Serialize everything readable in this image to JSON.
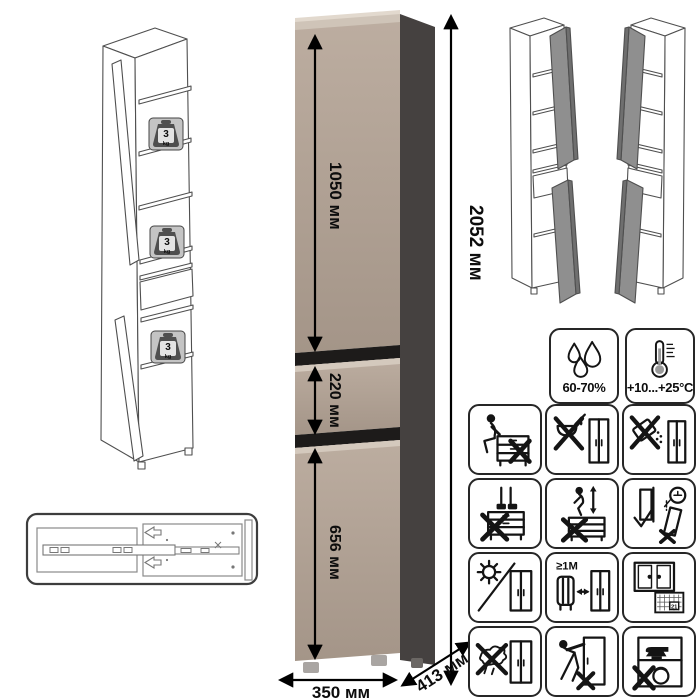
{
  "sheet": {
    "dimensions": {
      "total_height": "2052 мм",
      "upper_door_height": "1050 мм",
      "drawer_height": "220 мм",
      "lower_door_height": "656 мм",
      "width": "350 мм",
      "depth": "413 мм"
    },
    "shelf_load": {
      "value": "3",
      "unit": "kg"
    },
    "conditions": {
      "humidity": "60-70%",
      "temperature": "+10...+25°C"
    },
    "heat_distance_label": "≥1M",
    "ventilation_calendar_day": "21",
    "colors": {
      "cabinet_front": "#ae9e92",
      "cabinet_bevel": "#d4c9bd",
      "cabinet_side": "#454140",
      "panel_gap": "#1d1b1a",
      "variant_door_gray": "#8f8f8f"
    },
    "icons": {
      "info": [
        "humidity-icon",
        "temperature-icon"
      ],
      "warnings": [
        "no-sitting-icon",
        "no-liquids-icon",
        "no-abrasives-icon",
        "no-standing-icon",
        "no-climbing-icon",
        "anchor-to-wall-icon",
        "no-direct-sunlight-icon",
        "keep-1m-from-heat-icon",
        "ventilate-room-icon",
        "no-wet-cloth-icon",
        "no-dragging-icon",
        "no-heavy-items-icon"
      ]
    }
  }
}
